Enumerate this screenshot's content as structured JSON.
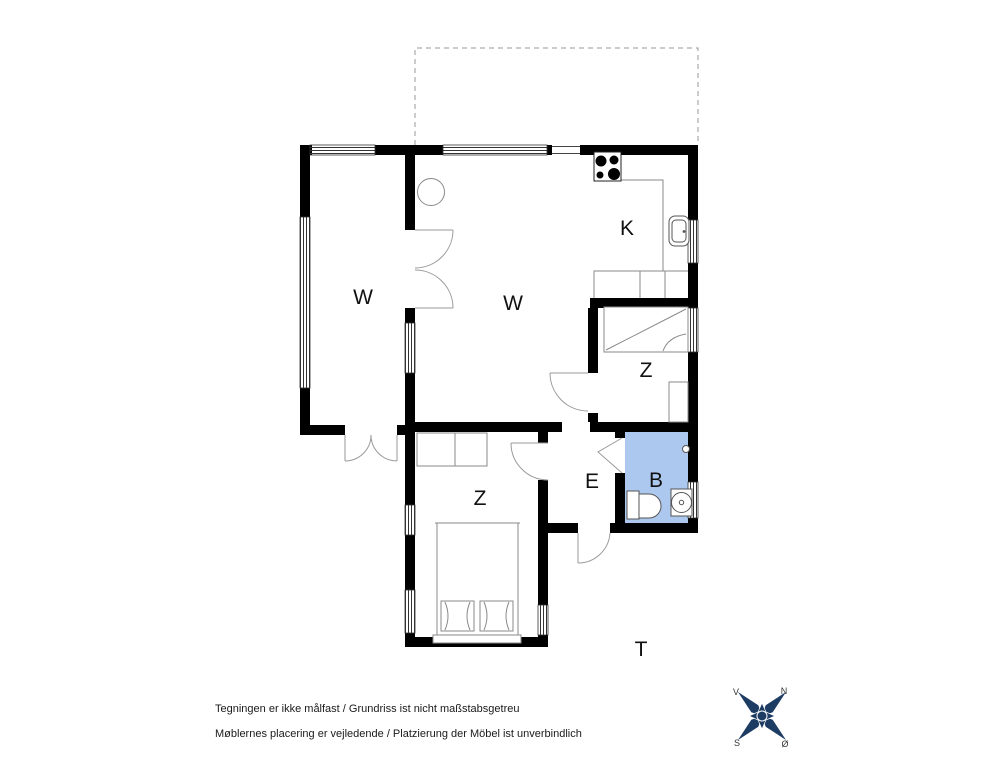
{
  "floorplan": {
    "rooms": [
      {
        "name": "living-room-left",
        "label": "W"
      },
      {
        "name": "living-room-main",
        "label": "W"
      },
      {
        "name": "kitchen",
        "label": "K"
      },
      {
        "name": "bedroom-upper",
        "label": "Z"
      },
      {
        "name": "bedroom-lower",
        "label": "Z"
      },
      {
        "name": "entrance",
        "label": "E"
      },
      {
        "name": "bathroom",
        "label": "B"
      },
      {
        "name": "terrace",
        "label": "T"
      }
    ],
    "colors": {
      "wall": "#000000",
      "furniture_line": "#8a8a8a",
      "bathroom_fill": "#adc8ef",
      "terrace_dash": "#999999"
    }
  },
  "compass": {
    "color": "#1d3c64",
    "letters": {
      "nw": "V",
      "ne": "N",
      "sw": "S",
      "se": "Ø"
    }
  },
  "footer": {
    "line1": "Tegningen er ikke målfast / Grundriss ist nicht maßstabsgetreu",
    "line2": "Møblernes placering er vejledende / Platzierung der Möbel ist unverbindlich"
  }
}
